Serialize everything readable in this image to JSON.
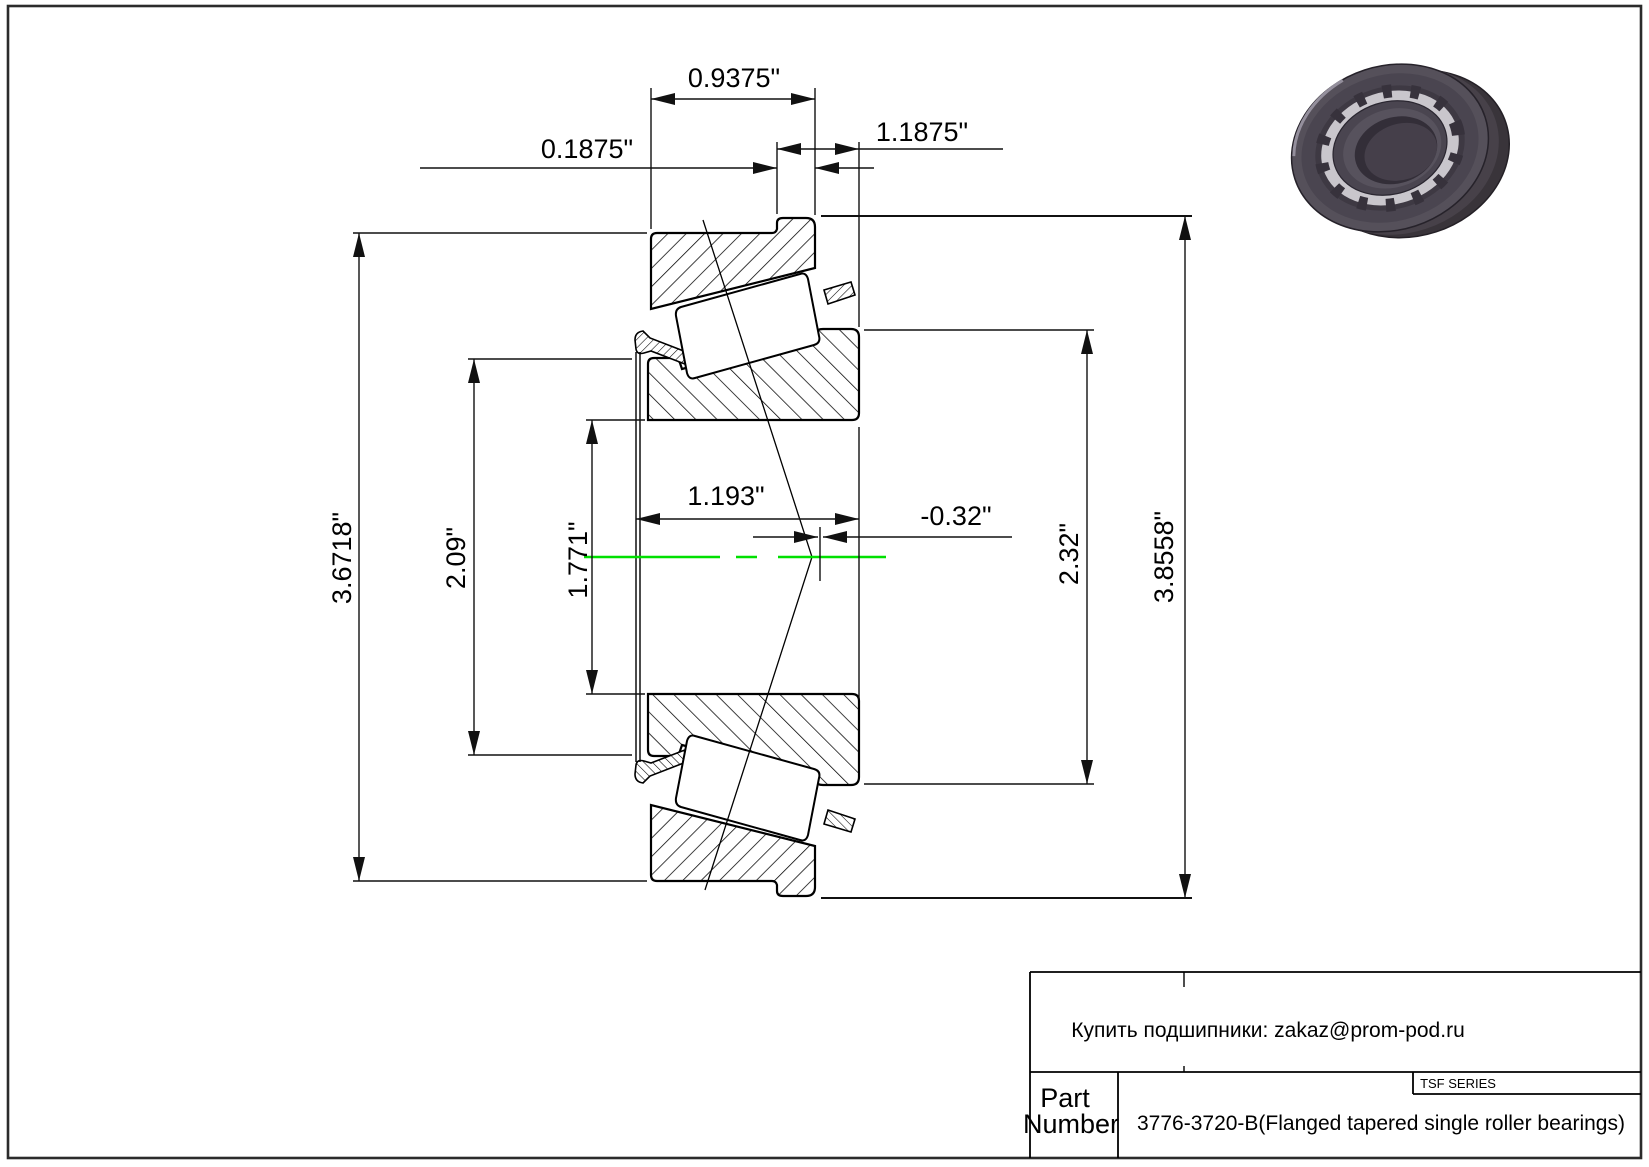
{
  "page": {
    "background": "#ffffff",
    "border_color": "#2b2b2b",
    "centerline_color": "#00e000",
    "line_color": "#000000"
  },
  "drawing": {
    "type": "bearing-cross-section",
    "dimensions": {
      "cup_width": "0.9375\"",
      "flange_width": "0.1875\"",
      "total_width": "1.1875\"",
      "cup_outer_diameter": "3.6718\"",
      "cone_front_rib_diameter": "2.09\"",
      "bore_diameter": "1.771\"",
      "cone_width": "1.193\"",
      "effective_center": "-0.32\"",
      "cone_back_rib_diameter": "2.32\"",
      "flange_outer_diameter": "3.8558\""
    }
  },
  "title_block": {
    "contact": "Купить подшипники: zakaz@prom-pod.ru",
    "series": "TSF SERIES",
    "part_label_line1": "Part",
    "part_label_line2": "Number",
    "part_number": "3776-3720-B(Flanged tapered single roller bearings)"
  }
}
